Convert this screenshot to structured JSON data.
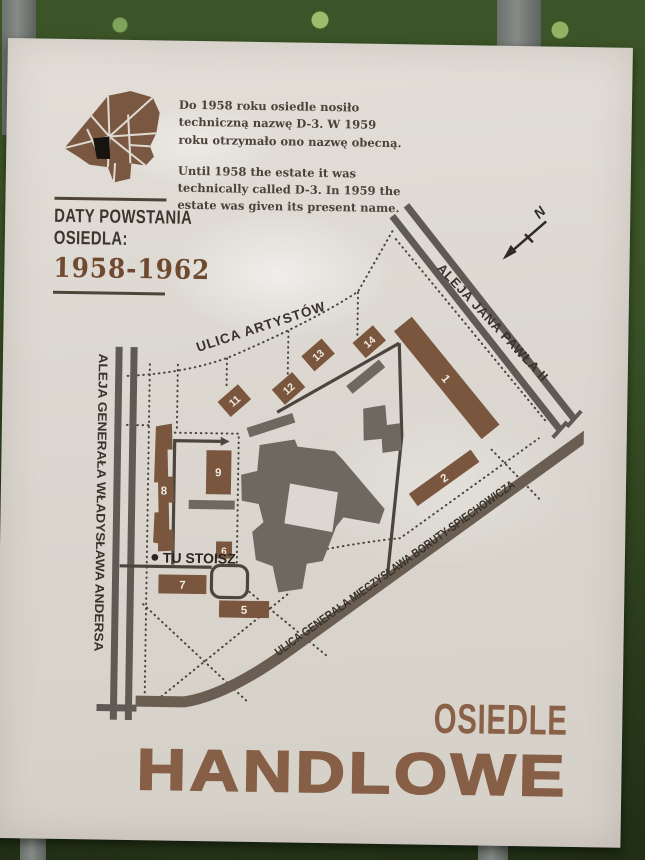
{
  "board": {
    "info": {
      "pl": [
        "Do 1958 roku osiedle nosiło",
        "techniczną nazwę D-3. W 1959",
        "roku otrzymało ono nazwę obecną."
      ],
      "en": [
        "Until 1958 the estate it was",
        "technically called D-3. In 1959 the",
        "estate was given its present name."
      ]
    },
    "dates": {
      "line1": "DATY POWSTANIA",
      "line2": "OSIEDLA:",
      "years": "1958-1962"
    },
    "streets": {
      "artystow": "ULICA ARTYSTÓW",
      "jana_pawla": "ALEJA JANA PAWŁA II",
      "andersa": "ALEJA GENERAŁA WŁADYSŁAWA ANDERSA",
      "boruty": "ULICA GENERAŁA MIECZYSŁAWA BORUTY-SPIECHOWICZA"
    },
    "you_are_here": "TU STOISZ",
    "compass_n": "N",
    "buildings": [
      "1",
      "2",
      "5",
      "6",
      "7",
      "8",
      "9",
      "11",
      "12",
      "13",
      "14"
    ],
    "title": {
      "line1": "OSIEDLE",
      "line2": "HANDLOWE"
    },
    "colors": {
      "building_brown": "#7a563e",
      "building_gray": "#6e6861",
      "street_gray": "#5f5a54",
      "accent_brown": "#6f4a31",
      "title_brown": "#875e46",
      "board_bg": "#dcd8d1",
      "text_dark": "#3b362e"
    }
  }
}
